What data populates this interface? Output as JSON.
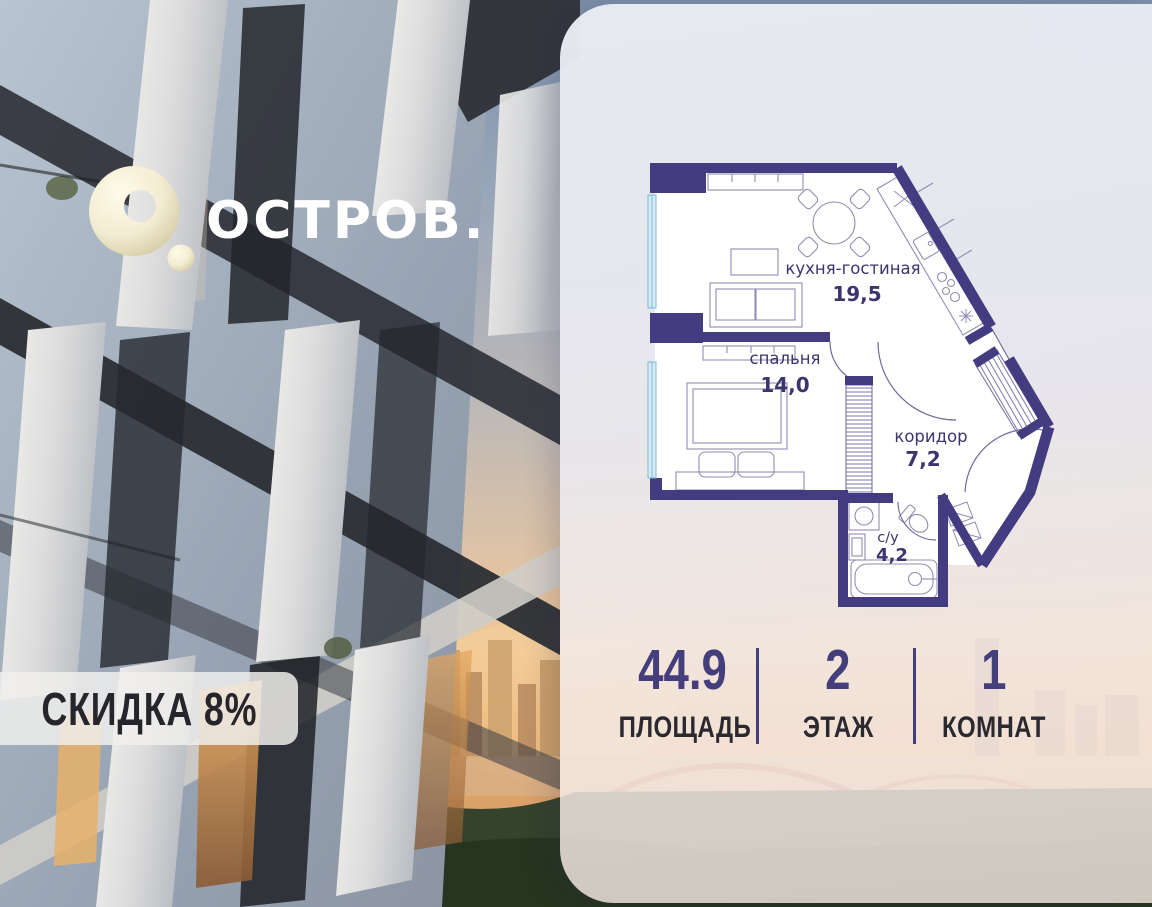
{
  "brand": {
    "wordmark": "ОСТРОВ."
  },
  "badge": {
    "text": "СКИДКА 8%"
  },
  "plan": {
    "rooms": [
      {
        "name": "кухня-гостиная",
        "area": "19,5"
      },
      {
        "name": "спальня",
        "area": "14,0"
      },
      {
        "name": "коридор",
        "area": "7,2"
      },
      {
        "name": "с/у",
        "area": "4,2"
      }
    ]
  },
  "stats": {
    "items": [
      {
        "value": "44.9",
        "label": "ПЛОЩАДЬ"
      },
      {
        "value": "2",
        "label": "ЭТАЖ"
      },
      {
        "value": "1",
        "label": "КОМНАТ"
      }
    ]
  },
  "colors": {
    "wall_purple": "#443c80",
    "accent_purple": "#453e7d",
    "label_dark": "#2a2930",
    "logo_cream": "#f3ecd2"
  }
}
